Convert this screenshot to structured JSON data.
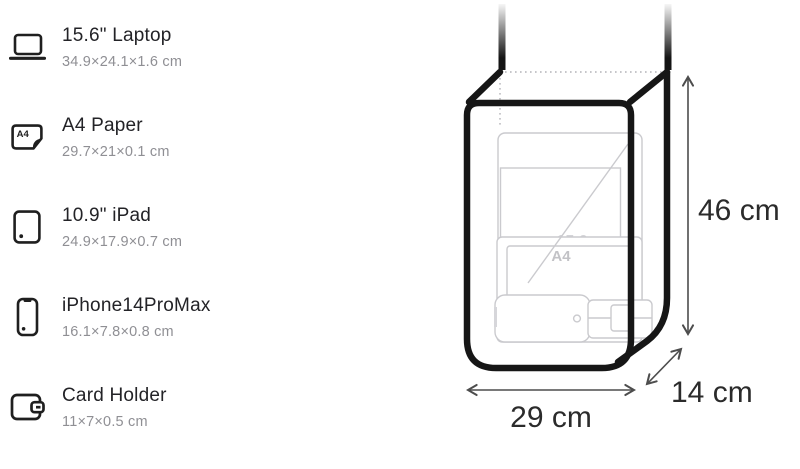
{
  "items": [
    {
      "name": "15.6\" Laptop",
      "dims": "34.9×24.1×1.6 cm"
    },
    {
      "name": "A4 Paper",
      "dims": "29.7×21×0.1 cm"
    },
    {
      "name": "10.9\" iPad",
      "dims": "24.9×17.9×0.7 cm"
    },
    {
      "name": "iPhone14ProMax",
      "dims": "16.1×7.8×0.8 cm"
    },
    {
      "name": "Card Holder",
      "dims": "11×7×0.5 cm"
    }
  ],
  "icons": {
    "a4_label": "A4"
  },
  "diagram": {
    "height_label": "46 cm",
    "width_label": "29 cm",
    "depth_label": "14 cm",
    "inner_labels": {
      "laptop_diagonal": "15.6",
      "paper": "A4"
    }
  },
  "colors": {
    "bag_outline": "#161616",
    "item_outline": "#cacace",
    "dimension_line": "#4d4d4d",
    "dimension_text": "#2b2b2b",
    "title_text": "#232327",
    "subtitle_text": "#8f8f94"
  }
}
